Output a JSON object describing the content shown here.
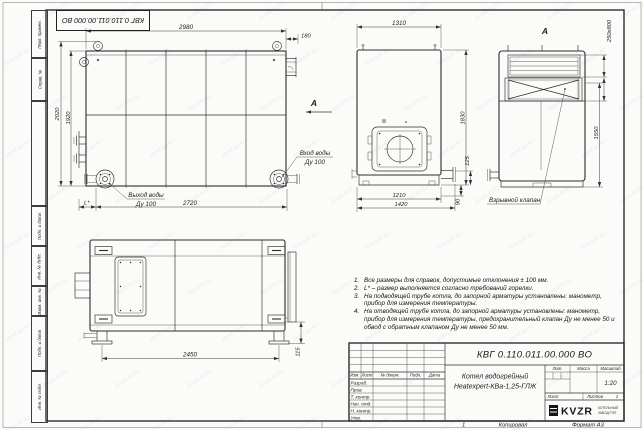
{
  "sheet": {
    "doc_stamp": "КВГ 0.110.011.00.000 ВО",
    "watermark_text": "kotel-kv.kz",
    "footer": {
      "zone": "1",
      "copied": "Копировал",
      "format": "Формат А3"
    }
  },
  "margin_fields": {
    "perv": "Перв. примен.",
    "sprav": "Справ. №",
    "podp1": "Подп. и дата",
    "inv_dubl": "Инв. № дубл.",
    "vzam": "Взам. инв. №",
    "podp2": "Подп. и дата",
    "inv_podl": "Инв. № подл."
  },
  "views": {
    "plan": {
      "dim_width": "2980",
      "dim_offset": "180",
      "dim_height_outer": "2020",
      "dim_height_inner": "1920",
      "dim_bottom": "2720",
      "dim_l": "L*",
      "outlet_line1": "Выход воды",
      "outlet_line2": "Ду 100",
      "inlet_line1": "Вход воды",
      "inlet_line2": "Ду 100",
      "view_arrow": "А"
    },
    "front": {
      "dim_top": "1310",
      "dim_right": "1830",
      "dim_125": "125",
      "dim_1210": "1210",
      "dim_1420": "1420",
      "dim_90": "90"
    },
    "section": {
      "view_label": "А",
      "dim_duct": "250x800",
      "dim_height": "1550",
      "valve_label": "Взрывной клапан"
    },
    "side": {
      "dim_bottom": "2450",
      "dim_right": "115"
    }
  },
  "notes": [
    {
      "num": "1.",
      "text": "Все размеры для справок, допустимые отклонения ± 100 мм."
    },
    {
      "num": "2.",
      "text": "L* – размер выполняется согласно требований горелки."
    },
    {
      "num": "3.",
      "text": "На подводящей трубе котла, до запорной арматуры установлены: манометр, прибор для измерения температуры."
    },
    {
      "num": "4.",
      "text": "На отводящей трубе котла, до запорной арматуры установлены: манометр, прибор для измерения температуры, предохранительный клапан Ду не менее 50 и обвод с обратным клапаном Ду не менее 50 мм."
    }
  ],
  "title_block": {
    "doc_number": "КВГ 0.110.011.00.000 ВО",
    "name_line1": "Котел водогрейный",
    "name_line2": "Heatexpert-КВа-1,25-ГЛЖ",
    "cols": {
      "izm": "Изм.",
      "list": "Лист",
      "doc": "№ докум.",
      "podp": "Подп.",
      "data": "Дата"
    },
    "rows": {
      "razrab": "Разраб.",
      "prov": "Пров.",
      "tkontr": "Т. контр.",
      "nachotd": "Нач. отд.",
      "nkontr": "Н. контр.",
      "utv": "Утв."
    },
    "lit": "Лит.",
    "mass": "Масса",
    "scale": "Масштаб",
    "scale_value": "1:20",
    "sheet": "Лист",
    "sheets": "Листов",
    "sheets_value": "1",
    "logo": "KVZR",
    "org_line1": "КОТЕЛЬНЫЙ",
    "org_line2": "ЗАВОД РЭП"
  }
}
